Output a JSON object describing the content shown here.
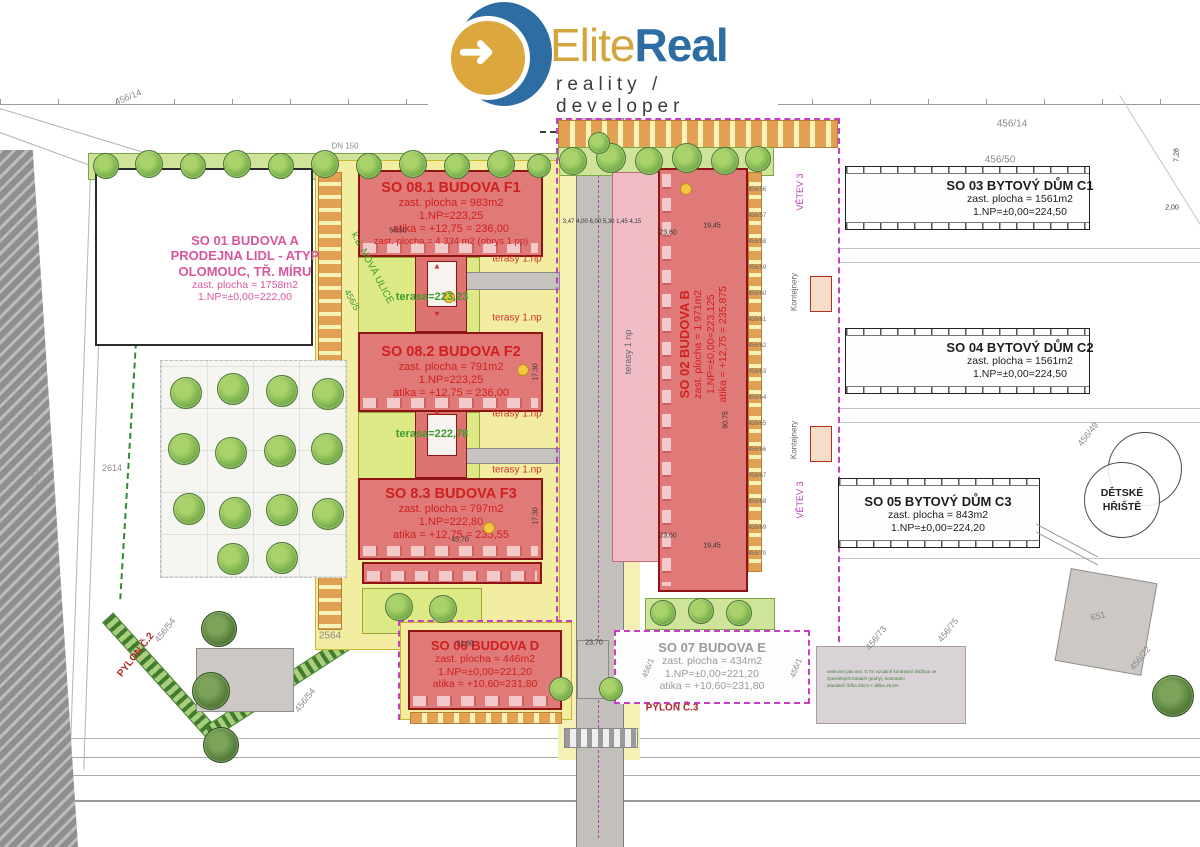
{
  "logo": {
    "elite": "Elite",
    "real": "Real",
    "tagline": "reality / developer"
  },
  "colors": {
    "accent_blue": "#2e6da4",
    "accent_gold": "#d2a53e",
    "building_red": "#e07a78",
    "zone_yellow": "#f2eda0",
    "label_pink": "#d8569d",
    "label_red": "#cf2020",
    "label_green": "#3f9b2f",
    "boundary_magenta": "#c53ec5"
  },
  "buildings": {
    "so01": {
      "l1": "SO 01 BUDOVA A",
      "l2": "PRODEJNA LIDL - ATYP",
      "l3": "OLOMOUC, TŘ. MÍRU",
      "l4": "zast. plocha = 1758m2",
      "l5": "1.NP=±0,00=222,00"
    },
    "so081": {
      "l1": "SO 08.1  BUDOVA F1",
      "l2": "zast. plocha = 983m2",
      "l3": "1.NP=223,25",
      "l4": "atika = +12,75 = 236,00",
      "l5": "zast. plocha = 4 334 m2 (obrys 1.pp)"
    },
    "so082": {
      "l1": "SO 08.2  BUDOVA F2",
      "l2": "zast. plocha = 791m2",
      "l3": "1.NP=223,25",
      "l4": "atika = +12,75 = 236,00"
    },
    "so083": {
      "l1": "SO 8.3  BUDOVA F3",
      "l2": "zast. plocha = 797m2",
      "l3": "1.NP=222,80",
      "l4": "atika = +12,75 = 235,55"
    },
    "so02": {
      "l1": "SO 02 BUDOVA B",
      "l2": "zast. plocha = 1 971m2",
      "l3": "1.NP=±0,00=223,125",
      "l4": "atika = +12,75 = 235,875"
    },
    "so03": {
      "l1": "SO 03 BYTOVÝ DŮM C1",
      "l2": "zast. plocha = 1561m2",
      "l3": "1.NP=±0,00=224,50"
    },
    "so04": {
      "l1": "SO 04 BYTOVÝ DŮM C2",
      "l2": "zast. plocha = 1561m2",
      "l3": "1.NP=±0,00=224,50"
    },
    "so05": {
      "l1": "SO 05 BYTOVÝ DŮM C3",
      "l2": "zast. plocha = 843m2",
      "l3": "1.NP=±0,00=224,20"
    },
    "so06": {
      "l1": "SO 06 BUDOVA D",
      "l2": "zast. plocha = 446m2",
      "l3": "1.NP=±0,00=221,20",
      "l4": "atika = +10,60=231,80"
    },
    "so07": {
      "l1": "SO 07 BUDOVA E",
      "l2": "zast. plocha = 434m2",
      "l3": "1.NP=±0,00=221,20",
      "l4": "atika = +10,60=231,80"
    }
  },
  "playground": {
    "l1": "DĚTSKÉ",
    "l2": "HŘIŠTĚ"
  },
  "note_lines": [
    "venkovní pás min. 0,7m vizuálně kontrastní dlažbou ve",
    "zpevněných trasách (pruhy), kontrastní",
    "standard: šířka 25cm × délka 25,5m"
  ],
  "annotations": [
    {
      "t": "456/14",
      "x": 128,
      "y": 97,
      "r": -22,
      "c": "gray",
      "s": 9
    },
    {
      "t": "DN 150",
      "x": 345,
      "y": 146,
      "c": "gray",
      "s": 8
    },
    {
      "t": "1,95",
      "x": 597,
      "y": 106,
      "c": "red",
      "s": 7
    },
    {
      "t": "2,01",
      "x": 667,
      "y": 106,
      "c": "dgray",
      "s": 7
    },
    {
      "t": "2,16",
      "x": 737,
      "y": 106,
      "c": "dgray",
      "s": 7
    },
    {
      "t": "456/14",
      "x": 1012,
      "y": 124,
      "c": "gray",
      "s": 10
    },
    {
      "t": "456/50",
      "x": 1000,
      "y": 160,
      "c": "gray",
      "s": 10
    },
    {
      "t": "56,50",
      "x": 398,
      "y": 231,
      "c": "black",
      "s": 7
    },
    {
      "t": "45,70",
      "x": 460,
      "y": 540,
      "c": "black",
      "s": 7
    },
    {
      "t": "31,60",
      "x": 465,
      "y": 644,
      "c": "black",
      "s": 7
    },
    {
      "t": "23,70",
      "x": 594,
      "y": 643,
      "c": "black",
      "s": 7
    },
    {
      "t": "23,60",
      "x": 668,
      "y": 233,
      "c": "black",
      "s": 7
    },
    {
      "t": "19,45",
      "x": 712,
      "y": 226,
      "c": "black",
      "s": 7
    },
    {
      "t": "23,60",
      "x": 668,
      "y": 536,
      "c": "black",
      "s": 7
    },
    {
      "t": "19,45",
      "x": 712,
      "y": 546,
      "c": "black",
      "s": 7
    },
    {
      "t": "3,47 4,00 6,00 5,30 1,45 4,15",
      "x": 602,
      "y": 222,
      "c": "black",
      "s": 6
    },
    {
      "t": "17,30",
      "x": 536,
      "y": 372,
      "r": -90,
      "c": "black",
      "s": 7
    },
    {
      "t": "17,30",
      "x": 536,
      "y": 516,
      "r": -90,
      "c": "black",
      "s": 7
    },
    {
      "t": "90,75",
      "x": 726,
      "y": 420,
      "r": -90,
      "c": "black",
      "s": 7
    },
    {
      "t": "7,28",
      "x": 1177,
      "y": 155,
      "r": -90,
      "c": "black",
      "s": 7
    },
    {
      "t": "2,00",
      "x": 1172,
      "y": 208,
      "c": "black",
      "s": 7
    },
    {
      "t": "k.ú. NOVÁ ULICE",
      "x": 372,
      "y": 268,
      "r": 62,
      "c": "green",
      "s": 10
    },
    {
      "t": "456/5",
      "x": 352,
      "y": 300,
      "r": 62,
      "c": "green",
      "s": 9
    },
    {
      "t": "2229",
      "x": 35,
      "y": 478,
      "r": -90,
      "c": "gray",
      "s": 9
    },
    {
      "t": "2614",
      "x": 112,
      "y": 468,
      "c": "gray",
      "s": 9
    },
    {
      "t": "2564",
      "x": 330,
      "y": 636,
      "c": "gray",
      "s": 10
    },
    {
      "t": "456/54",
      "x": 165,
      "y": 630,
      "r": -52,
      "c": "gray",
      "s": 9
    },
    {
      "t": "456/54",
      "x": 305,
      "y": 700,
      "r": -52,
      "c": "gray",
      "s": 9
    },
    {
      "t": "PYLON Č.2",
      "x": 136,
      "y": 655,
      "r": -52,
      "c": "red2",
      "s": 10,
      "b": 1
    },
    {
      "t": "PYLON Č.3",
      "x": 672,
      "y": 708,
      "c": "red2",
      "s": 10,
      "b": 1
    },
    {
      "t": "456/1",
      "x": 648,
      "y": 668,
      "r": -68,
      "c": "gray",
      "s": 8
    },
    {
      "t": "456/1",
      "x": 796,
      "y": 668,
      "r": -68,
      "c": "gray",
      "s": 8
    },
    {
      "t": "456/73",
      "x": 876,
      "y": 638,
      "r": -52,
      "c": "gray",
      "s": 9
    },
    {
      "t": "456/75",
      "x": 948,
      "y": 630,
      "r": -52,
      "c": "gray",
      "s": 9
    },
    {
      "t": "456/22",
      "x": 1140,
      "y": 658,
      "r": -52,
      "c": "gray",
      "s": 9
    },
    {
      "t": "651",
      "x": 1098,
      "y": 616,
      "r": -15,
      "c": "gray",
      "s": 9
    },
    {
      "t": "456/49",
      "x": 1088,
      "y": 434,
      "r": -52,
      "c": "gray",
      "s": 9
    },
    {
      "t": "456/56",
      "x": 757,
      "y": 190,
      "c": "dgray",
      "s": 6
    },
    {
      "t": "456/57",
      "x": 757,
      "y": 216,
      "c": "dgray",
      "s": 6
    },
    {
      "t": "456/58",
      "x": 757,
      "y": 242,
      "c": "dgray",
      "s": 6
    },
    {
      "t": "456/59",
      "x": 757,
      "y": 268,
      "c": "dgray",
      "s": 6
    },
    {
      "t": "456/60",
      "x": 757,
      "y": 294,
      "c": "dgray",
      "s": 6
    },
    {
      "t": "456/61",
      "x": 757,
      "y": 320,
      "c": "dgray",
      "s": 6
    },
    {
      "t": "456/62",
      "x": 757,
      "y": 346,
      "c": "dgray",
      "s": 6
    },
    {
      "t": "456/63",
      "x": 757,
      "y": 372,
      "c": "dgray",
      "s": 6
    },
    {
      "t": "456/64",
      "x": 757,
      "y": 398,
      "c": "dgray",
      "s": 6
    },
    {
      "t": "456/65",
      "x": 757,
      "y": 424,
      "c": "dgray",
      "s": 6
    },
    {
      "t": "456/66",
      "x": 757,
      "y": 450,
      "c": "dgray",
      "s": 6
    },
    {
      "t": "456/67",
      "x": 757,
      "y": 476,
      "c": "dgray",
      "s": 6
    },
    {
      "t": "456/68",
      "x": 757,
      "y": 502,
      "c": "dgray",
      "s": 6
    },
    {
      "t": "456/69",
      "x": 757,
      "y": 528,
      "c": "dgray",
      "s": 6
    },
    {
      "t": "456/70",
      "x": 757,
      "y": 554,
      "c": "dgray",
      "s": 6
    },
    {
      "t": "VĚTEV 3",
      "x": 800,
      "y": 192,
      "r": -90,
      "c": "purple",
      "s": 9
    },
    {
      "t": "VĚTEV 3",
      "x": 800,
      "y": 500,
      "r": -90,
      "c": "purple",
      "s": 9
    },
    {
      "t": "Kontejnery",
      "x": 794,
      "y": 292,
      "r": -90,
      "c": "dgray",
      "s": 8
    },
    {
      "t": "Kontejnery",
      "x": 794,
      "y": 440,
      "r": -90,
      "c": "dgray",
      "s": 8
    },
    {
      "t": "terasy 1.np",
      "x": 517,
      "y": 259,
      "c": "red",
      "s": 10
    },
    {
      "t": "terasy 1.np",
      "x": 517,
      "y": 318,
      "c": "red",
      "s": 10
    },
    {
      "t": "terasy 1.np",
      "x": 517,
      "y": 414,
      "c": "red",
      "s": 10
    },
    {
      "t": "terasy 1.np",
      "x": 517,
      "y": 470,
      "c": "red",
      "s": 10
    },
    {
      "t": "terasa=223,23",
      "x": 432,
      "y": 297,
      "c": "green",
      "s": 11,
      "b": 1
    },
    {
      "t": "terasa=222,78",
      "x": 432,
      "y": 434,
      "c": "green",
      "s": 11,
      "b": 1
    },
    {
      "t": "terasy 1 np",
      "x": 628,
      "y": 352,
      "r": -90,
      "c": "dgray",
      "s": 9
    },
    {
      "t": "▲",
      "x": 437,
      "y": 266,
      "c": "red",
      "s": 8
    },
    {
      "t": "▼",
      "x": 437,
      "y": 314,
      "c": "red",
      "s": 8
    },
    {
      "t": "▲",
      "x": 437,
      "y": 412,
      "c": "red",
      "s": 8
    }
  ]
}
